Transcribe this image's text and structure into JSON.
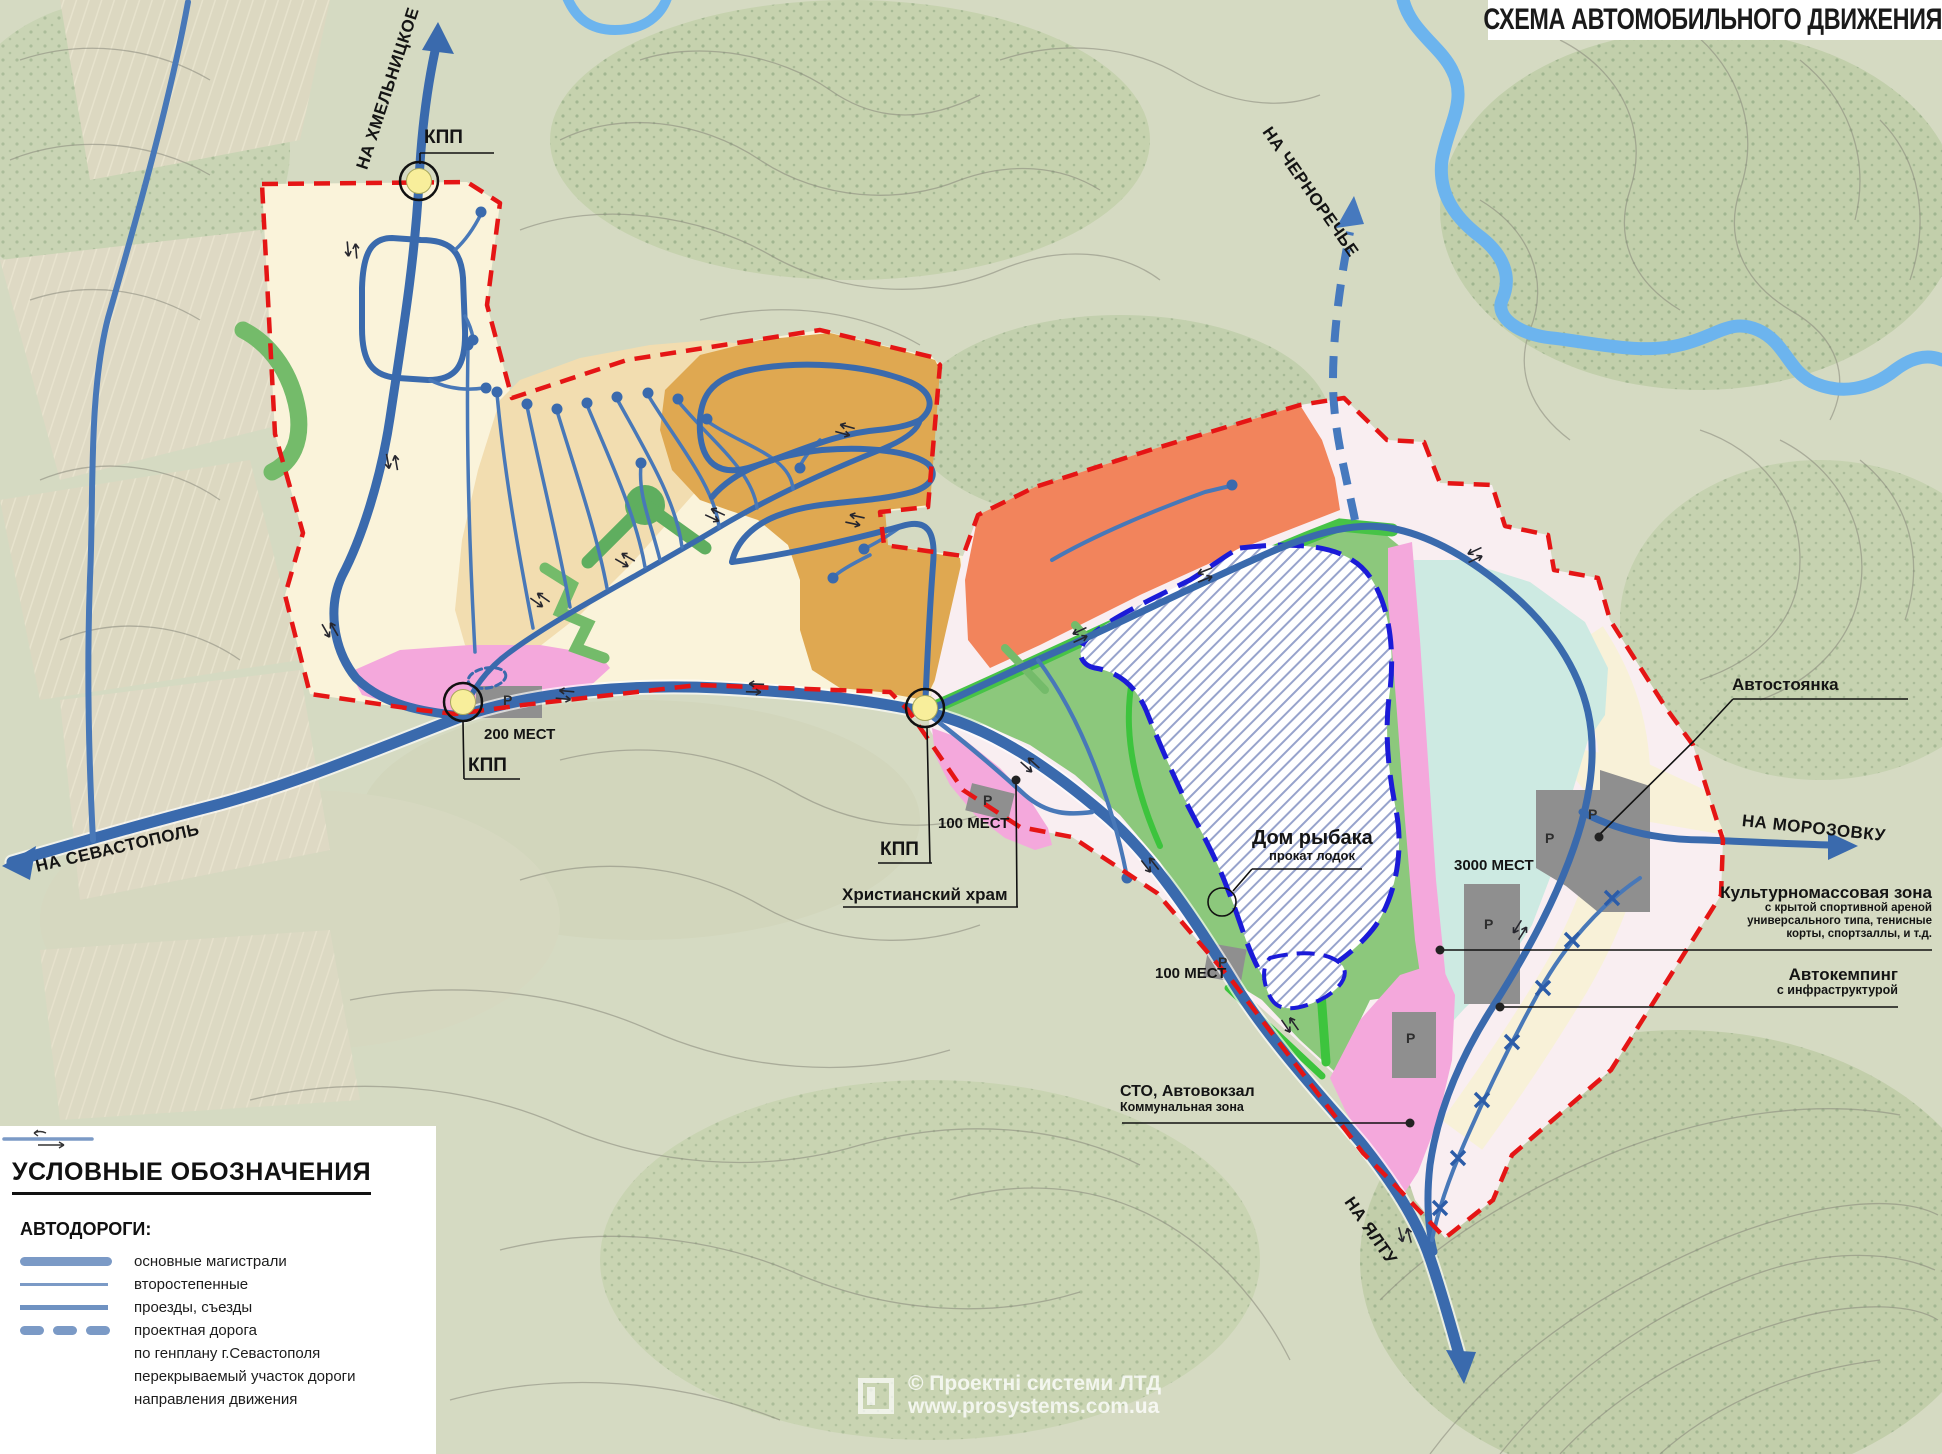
{
  "title": "СХЕМА АВТОМОБИЛЬНОГО ДВИЖЕНИЯ",
  "map": {
    "directions": {
      "khmelnitskoe": "НА ХМЕЛЬНИЦКОЕ",
      "chernorechye": "НА ЧЕРНОРЕЧЬЕ",
      "sevastopol": "НА СЕВАСТОПОЛЬ",
      "morozovka": "НА МОРОЗОВКУ",
      "yalta": "НА ЯЛТУ"
    },
    "checkpoint_label": "КПП",
    "parking_label": "P",
    "capacities": {
      "c200": "200 МЕСТ",
      "c100a": "100 МЕСТ",
      "c100b": "100 МЕСТ",
      "c3000": "3000 МЕСТ"
    },
    "pois": {
      "fisherman": {
        "title": "Дом рыбака",
        "subtitle": "прокат лодок"
      },
      "church": "Христианский храм",
      "parking_area": "Автостоянка",
      "cultural": {
        "title": "Культурномассовая зона",
        "line2": "с крытой спортивной ареной",
        "line3": "универсального типа, тенисные",
        "line4": "корты, спортзаллы, и т.д."
      },
      "camping": {
        "title": "Автокемпинг",
        "subtitle": "с инфраструктурой"
      },
      "sto": {
        "title": "СТО, Автовокзал",
        "subtitle": "Коммунальная зона"
      }
    }
  },
  "legend": {
    "title": "УСЛОВНЫЕ ОБОЗНАЧЕНИЯ",
    "subtitle": "АВТОДОРОГИ:",
    "items": [
      {
        "label": "основные магистрали",
        "symbol": "thick-line"
      },
      {
        "label": "второстепенные",
        "symbol": "thin-line"
      },
      {
        "label": "проезды, съезды",
        "symbol": "medium-line"
      },
      {
        "label": "проектная дорога",
        "symbol": "dashed-line"
      },
      {
        "label": "по генплану г.Севастополя",
        "symbol": "none"
      },
      {
        "label": "перекрываемый участок дороги",
        "symbol": "none"
      },
      {
        "label": "направления движения",
        "symbol": "arrow-line"
      }
    ]
  },
  "watermark": {
    "line1": "© Проектні системи ЛТД",
    "line2": "www.prosystems.com.ua"
  },
  "colors": {
    "boundary_red": "#e51515",
    "road_blue": "#3a6aad",
    "project_road_blue": "#4679be",
    "zone_cream": "#faf3da",
    "zone_tan": "#f2ddb0",
    "zone_ochre": "#dfa851",
    "zone_orange": "#f2845c",
    "zone_green": "#8cc87c",
    "zone_bright_green": "#3dc43d",
    "zone_pink": "#f4a8dc",
    "zone_light_pink": "#f9eef1",
    "zone_cyan": "#cdeae2",
    "parking_gray": "#8f8f8f",
    "lake_border_blue": "#1b1bd8",
    "river_blue": "#6cb4ee",
    "kpp_yellow": "#f8ee9b"
  }
}
